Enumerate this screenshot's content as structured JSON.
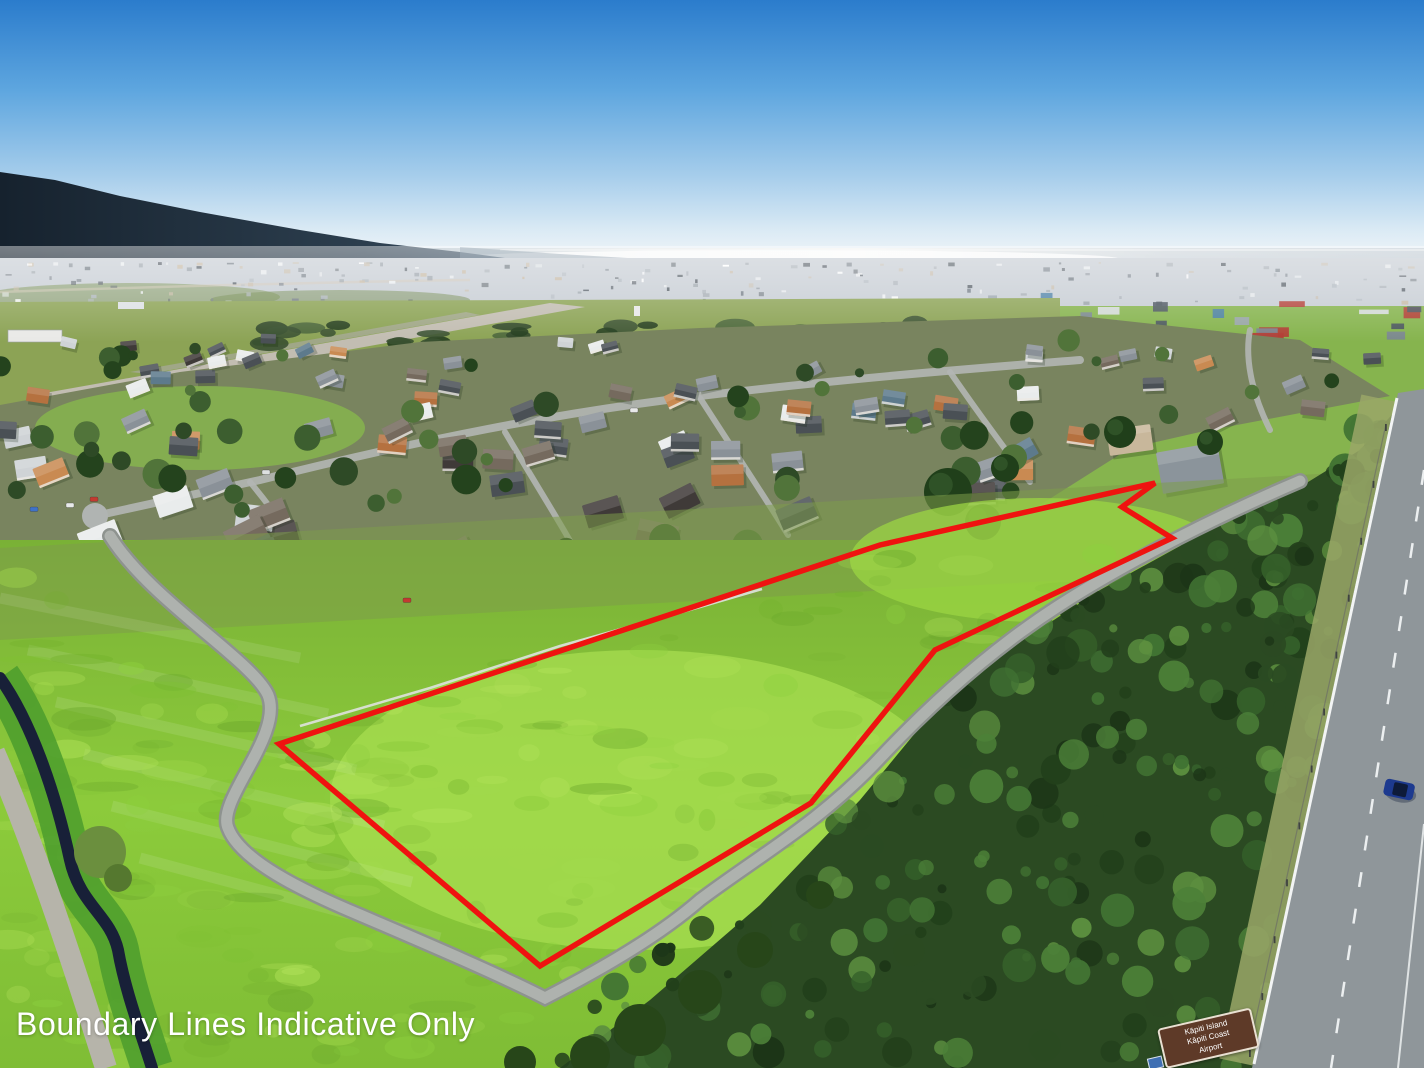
{
  "photo": {
    "kind": "aerial-drone-photograph",
    "scene": "Aerial view over a coastal town: sea and island silhouette on the horizon, airfield and runway in the mid-ground, suburban houses, a large open grass paddock outlined in red, dark scrub reserve and a state highway on the right"
  },
  "overlay": {
    "disclaimer": "Boundary Lines Indicative Only",
    "text_color": "#ffffff"
  },
  "boundary": {
    "color": "#ef1310",
    "stroke_width": 5.5,
    "points": "279,744 880,545 1155,483 1122,507 1172,538 935,650 811,803 540,966"
  },
  "road_sign": {
    "bg_color": "#5e3a28",
    "border_color": "#e9e0d2",
    "lines": [
      "Kāpiti Island",
      "Kāpiti Coast",
      "Airport"
    ]
  },
  "palette": {
    "sky_top": "#2b7ccc",
    "sky_mid": "#6fb0e2",
    "sky_horizon": "#eef4f9",
    "sea_left": "#8fa5b4",
    "sea_glare": "#f2f3f1",
    "sea_right": "#c2ccd4",
    "mountain_dark": "#1b2835",
    "mountain_light": "#41566a",
    "township": "#c7cdd4",
    "airfield_grass": "#8ca355",
    "runway": "#c2bdb2",
    "suburb_ground": "#79845f",
    "field_bright": "#8ccb3b",
    "field_light": "#a7dd50",
    "field_olive": "#7d9c4a",
    "bush_dark": "#2b4a22",
    "bush_mid": "#3a622c",
    "road": "#a4a8a4",
    "highway": "#8f969a",
    "stream": "#182038",
    "car_blue": "#1d3a8f"
  }
}
